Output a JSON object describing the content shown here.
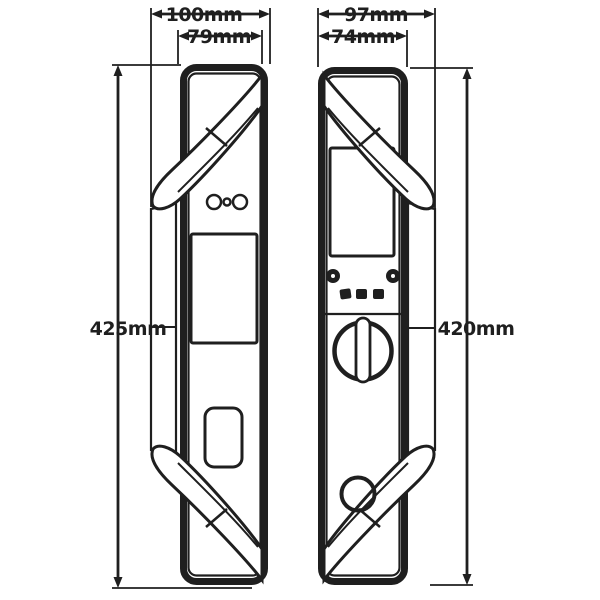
{
  "figure": {
    "type": "technical dimension drawing of smart door lock, front and back views",
    "views": {
      "front": {
        "overall_width": "100mm",
        "body_width": "79mm",
        "height": "425mm"
      },
      "back": {
        "overall_width": "97mm",
        "body_width": "74mm",
        "height": "420mm"
      }
    }
  },
  "colors": {
    "line": "#1f1f1f",
    "background": "#ffffff"
  }
}
